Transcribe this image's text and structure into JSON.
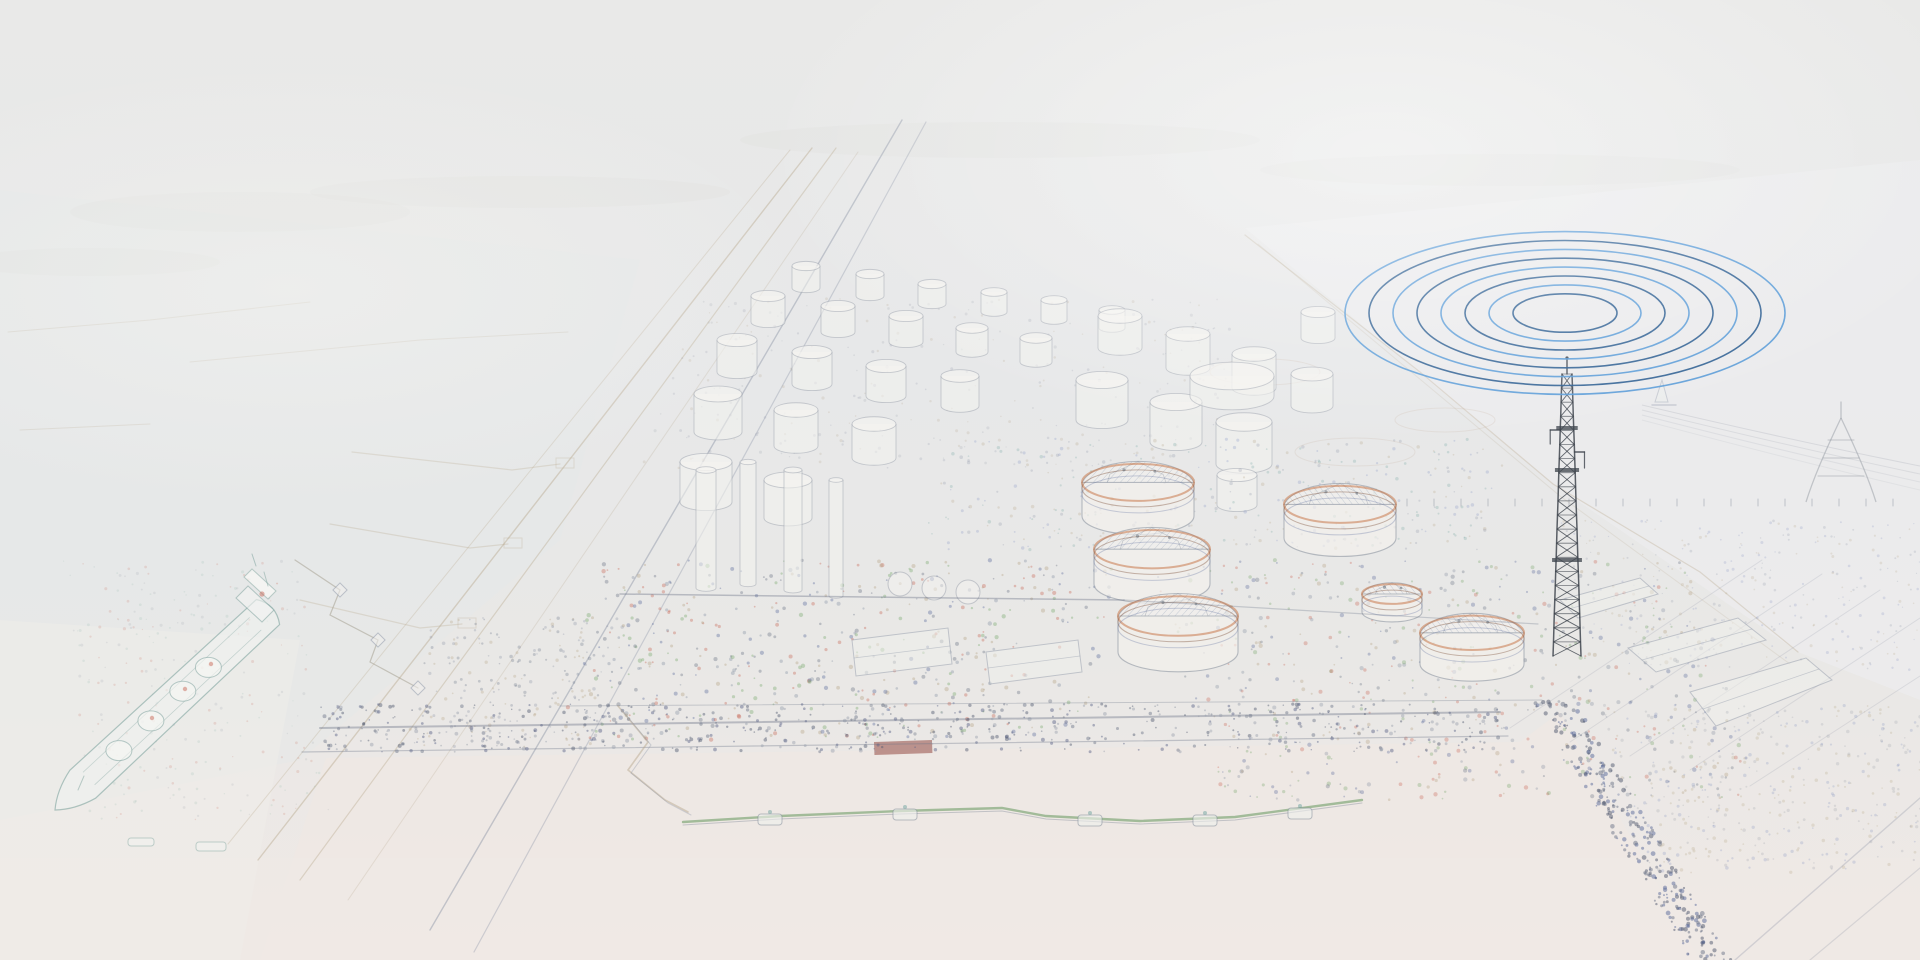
{
  "scene": {
    "description": "Faint pencil-sketch aerial view of a coastal LNG terminal; blue concentric radio-wave ellipses radiate from a dark lattice telecom mast at upper right; docked LNG tanker at left, domed storage tanks center, jetty and pale water along the bottom.",
    "width": 1920,
    "height": 960
  },
  "palette": {
    "haze_top": "#e9e9e8",
    "haze_mid": "#e6e7e9",
    "water_pink": "#f0e8e3",
    "sketch_gray": "#9aa0ac",
    "sketch_tan": "#b9a98f",
    "sketch_blue": "#7e8fc0",
    "sketch_teal": "#7fa39e",
    "sketch_green": "#6f9d68",
    "accent_red": "#c96a5a",
    "accent_orange": "#c9784a",
    "mast_gray": "#3f454d",
    "wave_dark_blue": "#2f5f93",
    "wave_light_blue": "#5b9cd8"
  },
  "radio_waves": {
    "cx": 1565,
    "cy": 313,
    "rings": 8,
    "rx0": 52,
    "step": 24,
    "aspect": 0.37,
    "width": 1.6,
    "colors": [
      "#2f5f93",
      "#5b9cd8"
    ]
  },
  "mast": {
    "cx": 1567,
    "top": 374,
    "base": 656,
    "wTop": 10,
    "wBase": 28,
    "segs": 20,
    "color": "#3f454d",
    "tip": 360,
    "platforms": [
      428,
      470,
      560
    ],
    "armLeft": 430,
    "armRight": 452
  },
  "large_tanks": [
    {
      "x": 1138,
      "y": 516,
      "r": 56
    },
    {
      "x": 1152,
      "y": 584,
      "r": 58
    },
    {
      "x": 1178,
      "y": 652,
      "r": 60
    },
    {
      "x": 1340,
      "y": 538,
      "r": 56
    },
    {
      "x": 1392,
      "y": 612,
      "r": 30
    },
    {
      "x": 1472,
      "y": 664,
      "r": 52
    }
  ],
  "small_tanks": [
    [
      706,
      502,
      26,
      40
    ],
    [
      788,
      518,
      24,
      38
    ],
    [
      718,
      432,
      24,
      38
    ],
    [
      796,
      446,
      22,
      36
    ],
    [
      874,
      458,
      22,
      34
    ],
    [
      737,
      372,
      20,
      32
    ],
    [
      812,
      384,
      20,
      32
    ],
    [
      886,
      396,
      20,
      30
    ],
    [
      960,
      406,
      19,
      30
    ],
    [
      768,
      322,
      17,
      26
    ],
    [
      838,
      332,
      17,
      26
    ],
    [
      906,
      342,
      17,
      26
    ],
    [
      972,
      352,
      16,
      24
    ],
    [
      1036,
      362,
      16,
      24
    ],
    [
      806,
      288,
      14,
      22
    ],
    [
      870,
      296,
      14,
      22
    ],
    [
      932,
      304,
      14,
      20
    ],
    [
      994,
      312,
      13,
      20
    ],
    [
      1054,
      320,
      13,
      20
    ],
    [
      1112,
      328,
      13,
      18
    ],
    [
      1102,
      420,
      26,
      40
    ],
    [
      1176,
      442,
      26,
      40
    ],
    [
      1244,
      464,
      28,
      42
    ],
    [
      1120,
      348,
      22,
      32
    ],
    [
      1188,
      368,
      22,
      34
    ],
    [
      1254,
      388,
      22,
      34
    ],
    [
      1312,
      406,
      21,
      32
    ],
    [
      1318,
      338,
      17,
      26
    ],
    [
      1237,
      505,
      20,
      30
    ],
    [
      1232,
      396,
      42,
      20
    ]
  ],
  "process_columns": [
    [
      706,
      588,
      10,
      118
    ],
    [
      748,
      584,
      8,
      122
    ],
    [
      793,
      590,
      9,
      120
    ],
    [
      836,
      596,
      7,
      116
    ]
  ],
  "spheres": [
    [
      900,
      584,
      12
    ],
    [
      934,
      588,
      12
    ],
    [
      968,
      592,
      12
    ]
  ],
  "warehouses": [
    [
      [
        1628,
        648
      ],
      [
        1738,
        618
      ],
      [
        1766,
        640
      ],
      [
        1656,
        672
      ]
    ],
    [
      [
        1690,
        692
      ],
      [
        1806,
        658
      ],
      [
        1832,
        680
      ],
      [
        1716,
        726
      ]
    ],
    [
      [
        1560,
        600
      ],
      [
        1640,
        578
      ],
      [
        1658,
        594
      ],
      [
        1578,
        618
      ]
    ],
    [
      [
        852,
        640
      ],
      [
        948,
        628
      ],
      [
        952,
        664
      ],
      [
        856,
        676
      ]
    ],
    [
      [
        986,
        652
      ],
      [
        1078,
        640
      ],
      [
        1082,
        672
      ],
      [
        990,
        684
      ]
    ]
  ],
  "red_shed": {
    "x": 874,
    "y": 742,
    "w": 58,
    "h": 13,
    "color": "#8c3b34"
  },
  "ship": {
    "bow": [
      55,
      810
    ],
    "stern": [
      268,
      612
    ],
    "half_width": 19,
    "outline": "#7fa39e",
    "hull_fill": "#f1f2f0",
    "dome_ts": [
      0.3,
      0.45,
      0.6,
      0.72
    ],
    "dome_rx": 13,
    "dome_ry": 10,
    "accents": [
      [
        152,
        718
      ],
      [
        185,
        689
      ],
      [
        211,
        664
      ]
    ],
    "accent_color": "#c96a5a"
  },
  "boats": [
    {
      "x": 128,
      "y": 838,
      "w": 26,
      "h": 8
    },
    {
      "x": 196,
      "y": 842,
      "w": 30,
      "h": 9
    }
  ],
  "boom": {
    "points": [
      [
        683,
        822
      ],
      [
        780,
        816
      ],
      [
        900,
        811
      ],
      [
        1002,
        808
      ],
      [
        1046,
        816
      ],
      [
        1140,
        821
      ],
      [
        1235,
        817
      ],
      [
        1362,
        800
      ]
    ],
    "pontoons": [
      [
        770,
        818
      ],
      [
        905,
        813
      ],
      [
        1090,
        819
      ],
      [
        1205,
        819
      ],
      [
        1300,
        812
      ]
    ],
    "color": "#6f9d68"
  },
  "catwalk": [
    [
      618,
      706
    ],
    [
      648,
      742
    ],
    [
      628,
      770
    ],
    [
      665,
      800
    ],
    [
      688,
      812
    ]
  ],
  "mooring": {
    "path": [
      [
        295,
        560
      ],
      [
        340,
        590
      ],
      [
        330,
        615
      ],
      [
        378,
        640
      ],
      [
        370,
        662
      ],
      [
        418,
        688
      ]
    ],
    "piers": [
      [
        340,
        590
      ],
      [
        378,
        640
      ],
      [
        418,
        688
      ]
    ]
  },
  "corridor_lines": [
    {
      "pts": [
        [
          790,
          150
        ],
        [
          228,
          844
        ]
      ],
      "c": "#b9a98f",
      "w": 1.0,
      "o": 0.3
    },
    {
      "pts": [
        [
          812,
          148
        ],
        [
          258,
          860
        ]
      ],
      "c": "#b9a98f",
      "w": 1.4,
      "o": 0.45
    },
    {
      "pts": [
        [
          836,
          148
        ],
        [
          300,
          880
        ]
      ],
      "c": "#b9a98f",
      "w": 1.2,
      "o": 0.4
    },
    {
      "pts": [
        [
          858,
          152
        ],
        [
          348,
          900
        ]
      ],
      "c": "#b9a98f",
      "w": 1.0,
      "o": 0.25
    },
    {
      "pts": [
        [
          902,
          120
        ],
        [
          430,
          930
        ]
      ],
      "c": "#8a93a5",
      "w": 1.4,
      "o": 0.45
    },
    {
      "pts": [
        [
          926,
          122
        ],
        [
          474,
          952
        ]
      ],
      "c": "#8a93a5",
      "w": 1.2,
      "o": 0.35
    }
  ],
  "boundary_lines": [
    {
      "pts": [
        [
          1245,
          235
        ],
        [
          1420,
          372
        ],
        [
          1553,
          484
        ],
        [
          1700,
          572
        ],
        [
          1798,
          652
        ]
      ],
      "c": "#b9a98f",
      "w": 1.2,
      "o": 0.35
    },
    {
      "pts": [
        [
          1258,
          244
        ],
        [
          1560,
          496
        ],
        [
          1790,
          664
        ]
      ],
      "c": "#b9a98f",
      "w": 1.0,
      "o": 0.2
    }
  ],
  "quay_lines": [
    {
      "pts": [
        [
          320,
          728
        ],
        [
          1500,
          712
        ]
      ],
      "c": "#6b7487",
      "w": 2.0,
      "o": 0.4
    },
    {
      "pts": [
        [
          302,
          752
        ],
        [
          1508,
          736
        ]
      ],
      "c": "#6b7487",
      "w": 1.2,
      "o": 0.35
    },
    {
      "pts": [
        [
          620,
          594
        ],
        [
          1124,
          600
        ]
      ],
      "c": "#6b7487",
      "w": 1.5,
      "o": 0.4
    },
    {
      "pts": [
        [
          1124,
          600
        ],
        [
          1538,
          624
        ]
      ],
      "c": "#6b7487",
      "w": 1.2,
      "o": 0.3
    },
    {
      "pts": [
        [
          560,
          706
        ],
        [
          1542,
          700
        ]
      ],
      "c": "#6b7487",
      "w": 1.0,
      "o": 0.3
    }
  ],
  "sidings": [
    {
      "pts": [
        [
          1510,
          728
        ],
        [
          1762,
          560
        ]
      ],
      "c": "#8a93a5",
      "w": 1,
      "o": 0.2
    },
    {
      "pts": [
        [
          1570,
          742
        ],
        [
          1822,
          574
        ]
      ],
      "c": "#8a93a5",
      "w": 1,
      "o": 0.2
    },
    {
      "pts": [
        [
          1630,
          756
        ],
        [
          1880,
          590
        ]
      ],
      "c": "#8a93a5",
      "w": 1,
      "o": 0.2
    },
    {
      "pts": [
        [
          1690,
          770
        ],
        [
          1920,
          618
        ]
      ],
      "c": "#8a93a5",
      "w": 1,
      "o": 0.2
    },
    {
      "pts": [
        [
          1750,
          786
        ],
        [
          1920,
          676
        ]
      ],
      "c": "#8a93a5",
      "w": 1,
      "o": 0.2
    }
  ],
  "bottom_diagonals": [
    {
      "pts": [
        [
          1735,
          960
        ],
        [
          1920,
          798
        ]
      ],
      "c": "#8a93a5",
      "w": 1.4,
      "o": 0.3
    },
    {
      "pts": [
        [
          1810,
          960
        ],
        [
          1920,
          868
        ]
      ],
      "c": "#8a93a5",
      "w": 1.2,
      "o": 0.25
    }
  ],
  "jetty_fingers": [
    [
      [
        352,
        452
      ],
      [
        512,
        470
      ],
      [
        560,
        464
      ]
    ],
    [
      [
        330,
        524
      ],
      [
        470,
        548
      ],
      [
        508,
        544
      ]
    ],
    [
      [
        300,
        600
      ],
      [
        420,
        628
      ],
      [
        462,
        624
      ]
    ]
  ],
  "breakwaters": [
    [
      [
        8,
        332
      ],
      [
        150,
        320
      ],
      [
        310,
        302
      ]
    ],
    [
      [
        190,
        362
      ],
      [
        420,
        340
      ],
      [
        568,
        332
      ]
    ],
    [
      [
        20,
        430
      ],
      [
        150,
        424
      ]
    ]
  ],
  "clearings": [
    [
      1445,
      420,
      50,
      12
    ],
    [
      1265,
      372,
      55,
      13
    ],
    [
      1355,
      452,
      60,
      14
    ]
  ],
  "washes": [
    {
      "pts": [
        [
          1245,
          228
        ],
        [
          1920,
          160
        ],
        [
          1920,
          700
        ],
        [
          1798,
          652
        ],
        [
          1553,
          484
        ]
      ],
      "fill": "#ecedee",
      "o": 0.7
    },
    {
      "pts": [
        [
          0,
          190
        ],
        [
          640,
          260
        ],
        [
          560,
          540
        ],
        [
          300,
          760
        ],
        [
          0,
          820
        ]
      ],
      "fill": "#e5e8e8",
      "o": 0.45
    },
    {
      "pts": [
        [
          260,
          960
        ],
        [
          326,
          758
        ],
        [
          1520,
          742
        ],
        [
          1560,
          712
        ],
        [
          1700,
          960
        ]
      ],
      "fill": "#f0e8e3",
      "o": 0.65
    },
    {
      "pts": [
        [
          0,
          858
        ],
        [
          1920,
          858
        ],
        [
          1920,
          960
        ],
        [
          0,
          960
        ]
      ],
      "fill": "#f0e9e5",
      "o": 0.5
    },
    {
      "pts": [
        [
          0,
          620
        ],
        [
          300,
          640
        ],
        [
          240,
          960
        ],
        [
          0,
          960
        ]
      ],
      "fill": "#efedea",
      "o": 0.5
    }
  ],
  "haze_blobs": [
    [
      240,
      212,
      170,
      20
    ],
    [
      520,
      192,
      210,
      16
    ],
    [
      90,
      262,
      130,
      14
    ],
    [
      1000,
      140,
      260,
      18
    ],
    [
      1500,
      170,
      240,
      16
    ]
  ],
  "horizon_ticks": {
    "y": 506,
    "x0": 1380,
    "x1": 1912,
    "step": 27,
    "h": 7,
    "color": "#6b7487"
  },
  "pylon": {
    "apex": [
      1841,
      418
    ],
    "tip": [
      1841,
      402
    ],
    "legL": [
      1806,
      502
    ],
    "legR": [
      1876,
      502
    ],
    "arms": [
      [
        440,
        26
      ],
      [
        458,
        36
      ],
      [
        476,
        46
      ]
    ],
    "color": "#8b929c"
  },
  "cable_band": {
    "x0": 1642,
    "y0": 405,
    "qx": 1790,
    "qy": 440,
    "x1": 1920,
    "y1": 466,
    "lines": 4,
    "gap": 5
  },
  "sailboat": {
    "x": 1662,
    "y": 402,
    "color": "#8a93a5"
  },
  "speckle_regions": [
    {
      "x": 600,
      "y": 560,
      "w": 520,
      "h": 180,
      "skew": -40,
      "count": 550,
      "s0": 0.8,
      "s1": 2.2,
      "o": 0.38,
      "seed": 7,
      "colors": [
        "#5a6a9a",
        "#8a93a5",
        "#b5a285",
        "#7aa86f",
        "#c96a5a",
        "#6b7487"
      ]
    },
    {
      "x": 1150,
      "y": 560,
      "w": 540,
      "h": 240,
      "skew": 70,
      "count": 620,
      "s0": 0.8,
      "s1": 2.2,
      "o": 0.34,
      "seed": 11,
      "colors": [
        "#5a6a9a",
        "#8a93a5",
        "#b5a285",
        "#7aa86f",
        "#c96a5a",
        "#6b7487"
      ]
    },
    {
      "x": 320,
      "y": 704,
      "w": 1185,
      "h": 48,
      "skew": 0,
      "count": 560,
      "s0": 0.7,
      "s1": 2.0,
      "o": 0.45,
      "seed": 23,
      "colors": [
        "#566086",
        "#6b7487",
        "#9aa0ac",
        "#4f586e"
      ]
    },
    {
      "x": 1532,
      "y": 700,
      "w": 42,
      "h": 260,
      "skew": 158,
      "count": 300,
      "s0": 0.8,
      "s1": 2.4,
      "o": 0.5,
      "seed": 31,
      "colors": [
        "#4f586e",
        "#5a6a9a",
        "#6b7487"
      ]
    },
    {
      "x": 1600,
      "y": 705,
      "w": 320,
      "h": 170,
      "skew": 42,
      "count": 430,
      "s0": 0.7,
      "s1": 1.8,
      "o": 0.25,
      "seed": 41,
      "colors": [
        "#7e8fc0",
        "#9aa0ac",
        "#b5a285"
      ]
    },
    {
      "x": 700,
      "y": 298,
      "w": 560,
      "h": 170,
      "skew": -60,
      "count": 300,
      "s0": 0.6,
      "s1": 1.6,
      "o": 0.2,
      "seed": 53,
      "colors": [
        "#9aa0ac",
        "#b5a285",
        "#8a93a5"
      ]
    },
    {
      "x": 950,
      "y": 438,
      "w": 560,
      "h": 112,
      "skew": -30,
      "count": 380,
      "s0": 0.7,
      "s1": 1.8,
      "o": 0.26,
      "seed": 61,
      "colors": [
        "#7e8fc0",
        "#8a93a5",
        "#b5a285",
        "#6fa3a0"
      ]
    },
    {
      "x": 1560,
      "y": 520,
      "w": 360,
      "h": 150,
      "skew": 30,
      "count": 300,
      "s0": 0.6,
      "s1": 1.6,
      "o": 0.22,
      "seed": 71,
      "colors": [
        "#8a93a5",
        "#7e8fc0",
        "#b5a285"
      ]
    },
    {
      "x": 430,
      "y": 618,
      "w": 200,
      "h": 130,
      "skew": -30,
      "count": 220,
      "s0": 0.7,
      "s1": 1.8,
      "o": 0.3,
      "seed": 83,
      "colors": [
        "#6b7487",
        "#8a93a5",
        "#b5a285"
      ]
    },
    {
      "x": 60,
      "y": 560,
      "w": 240,
      "h": 260,
      "skew": 30,
      "count": 260,
      "s0": 0.6,
      "s1": 1.6,
      "o": 0.18,
      "seed": 97,
      "colors": [
        "#8fb5ae",
        "#9aa0ac",
        "#c96a5a"
      ]
    }
  ]
}
